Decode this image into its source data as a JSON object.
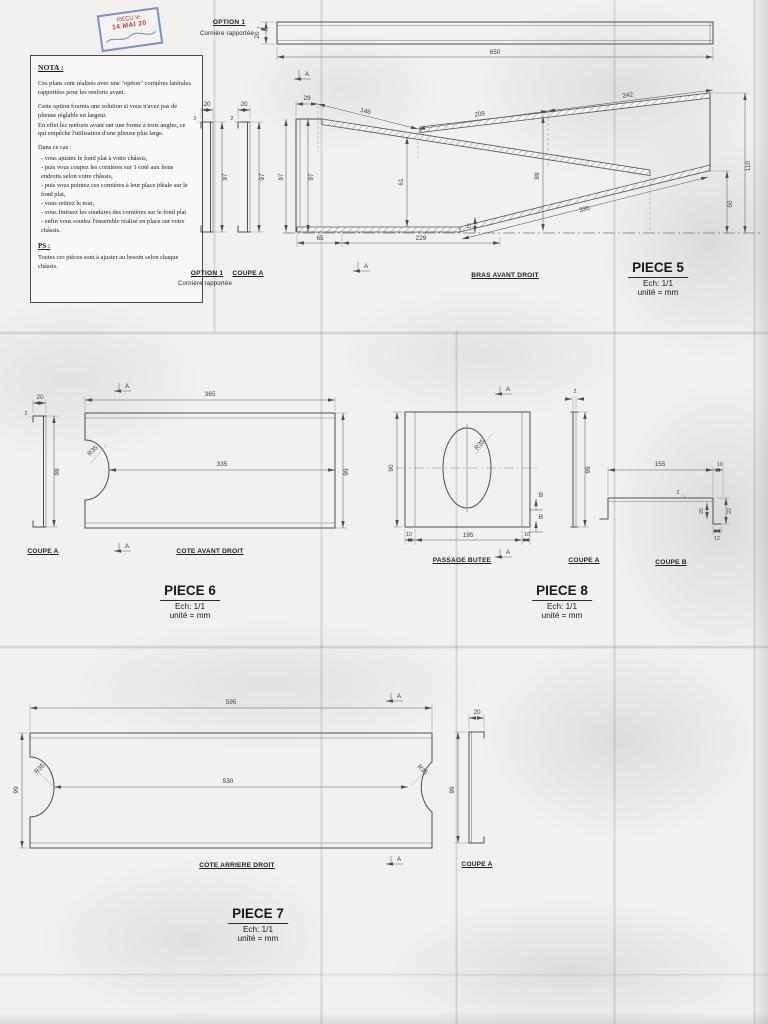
{
  "stamp": {
    "line1": "REÇU le",
    "line2": "14 MAI 20"
  },
  "nota": {
    "title": "NOTA :",
    "p1": "Ces plans sont réalisés avec une \"option\" cornières latérales rapportées pour les renforts avant.",
    "p2": "Cette option fournis une solution si vous n'avez pas de plieuse réglable en largeur.",
    "p3": "En effet les renforts avant ont une forme à trois angles, ce qui empêche l'utilisation d'une plieuse plus large.",
    "case_intro": "Dans ce cas :",
    "bullets": [
      "- vous ajustez le fond plat à votre châssis,",
      "- puis vous coupez les cornières sur 1 coté aux bons endroits selon votre châssis,",
      "- puis vous pointez ces cornières à leur place idéale sur le fond plat,",
      "- vous retirez le tout,",
      "- vous finissez les soudures des cornières sur le fond plat",
      "- enfin vous soudez l'ensemble réalisé en place sur votre châssis."
    ],
    "ps_title": "PS :",
    "ps_text": "Toutes ces pièces sont à ajuster au besoin selon chaque châssis."
  },
  "piece5": {
    "option_label": "OPTION 1",
    "option_sub": "Cornière rapportée",
    "bar_thickness": "20",
    "bar_length": "650",
    "profile1_label": "OPTION 1",
    "profile1_sub": "Cornière rapportée",
    "profile2_label": "COUPE A",
    "profile_w1": "20",
    "profile_h1": "97",
    "profile_t1": "2",
    "profile_w2": "20",
    "profile_h2": "97",
    "profile_t2": "2",
    "drawing_label": "BRAS AVANT DROIT",
    "dims": {
      "top1": "29",
      "top2": "146",
      "top3": "205",
      "top4": "242",
      "left1": "97",
      "left2": "97",
      "mid1": "61",
      "mid2": "89",
      "small": "15",
      "bot1": "65",
      "bot2": "229",
      "slope": "330",
      "right1": "110",
      "right2": "60"
    },
    "section_letter": "A",
    "title": "PIECE 5",
    "scale": "Ech: 1/1",
    "unit": "unité = mm"
  },
  "piece6": {
    "coupe_label": "COUPE A",
    "coupe_w": "20",
    "coupe_h": "99",
    "coupe_t": "2",
    "plate_label": "COTE AVANT DROIT",
    "dims": {
      "top": "365",
      "mid": "335",
      "height": "99",
      "radius": "R35"
    },
    "section_letter": "A",
    "title": "PIECE 6",
    "scale": "Ech: 1/1",
    "unit": "unité = mm"
  },
  "piece8": {
    "plate_label": "PASSAGE BUTEE",
    "dims": {
      "height": "90",
      "bot_left": "10",
      "bot_mid": "195",
      "bot_right": "10",
      "radius": "R35"
    },
    "coupea_label": "COUPE A",
    "coupea_t": "2",
    "coupea_h": "99",
    "coupeb_label": "COUPE B",
    "coupeb_dims": {
      "top": "155",
      "top_right": "10",
      "t": "2",
      "v_inner": "20",
      "v_outer": "22",
      "foot": "12"
    },
    "section_letter_a": "A",
    "section_letter_b": "B",
    "title": "PIECE 8",
    "scale": "Ech: 1/1",
    "unit": "unité = mm"
  },
  "piece7": {
    "plate_label": "COTE ARRIERE DROIT",
    "dims": {
      "top": "595",
      "mid": "530",
      "height": "99",
      "radius_left": "R35",
      "radius_right": "R35"
    },
    "coupe_label": "COUPE A",
    "coupe_w": "20",
    "coupe_h": "99",
    "section_letter": "A",
    "title": "PIECE 7",
    "scale": "Ech: 1/1",
    "unit": "unité = mm"
  }
}
